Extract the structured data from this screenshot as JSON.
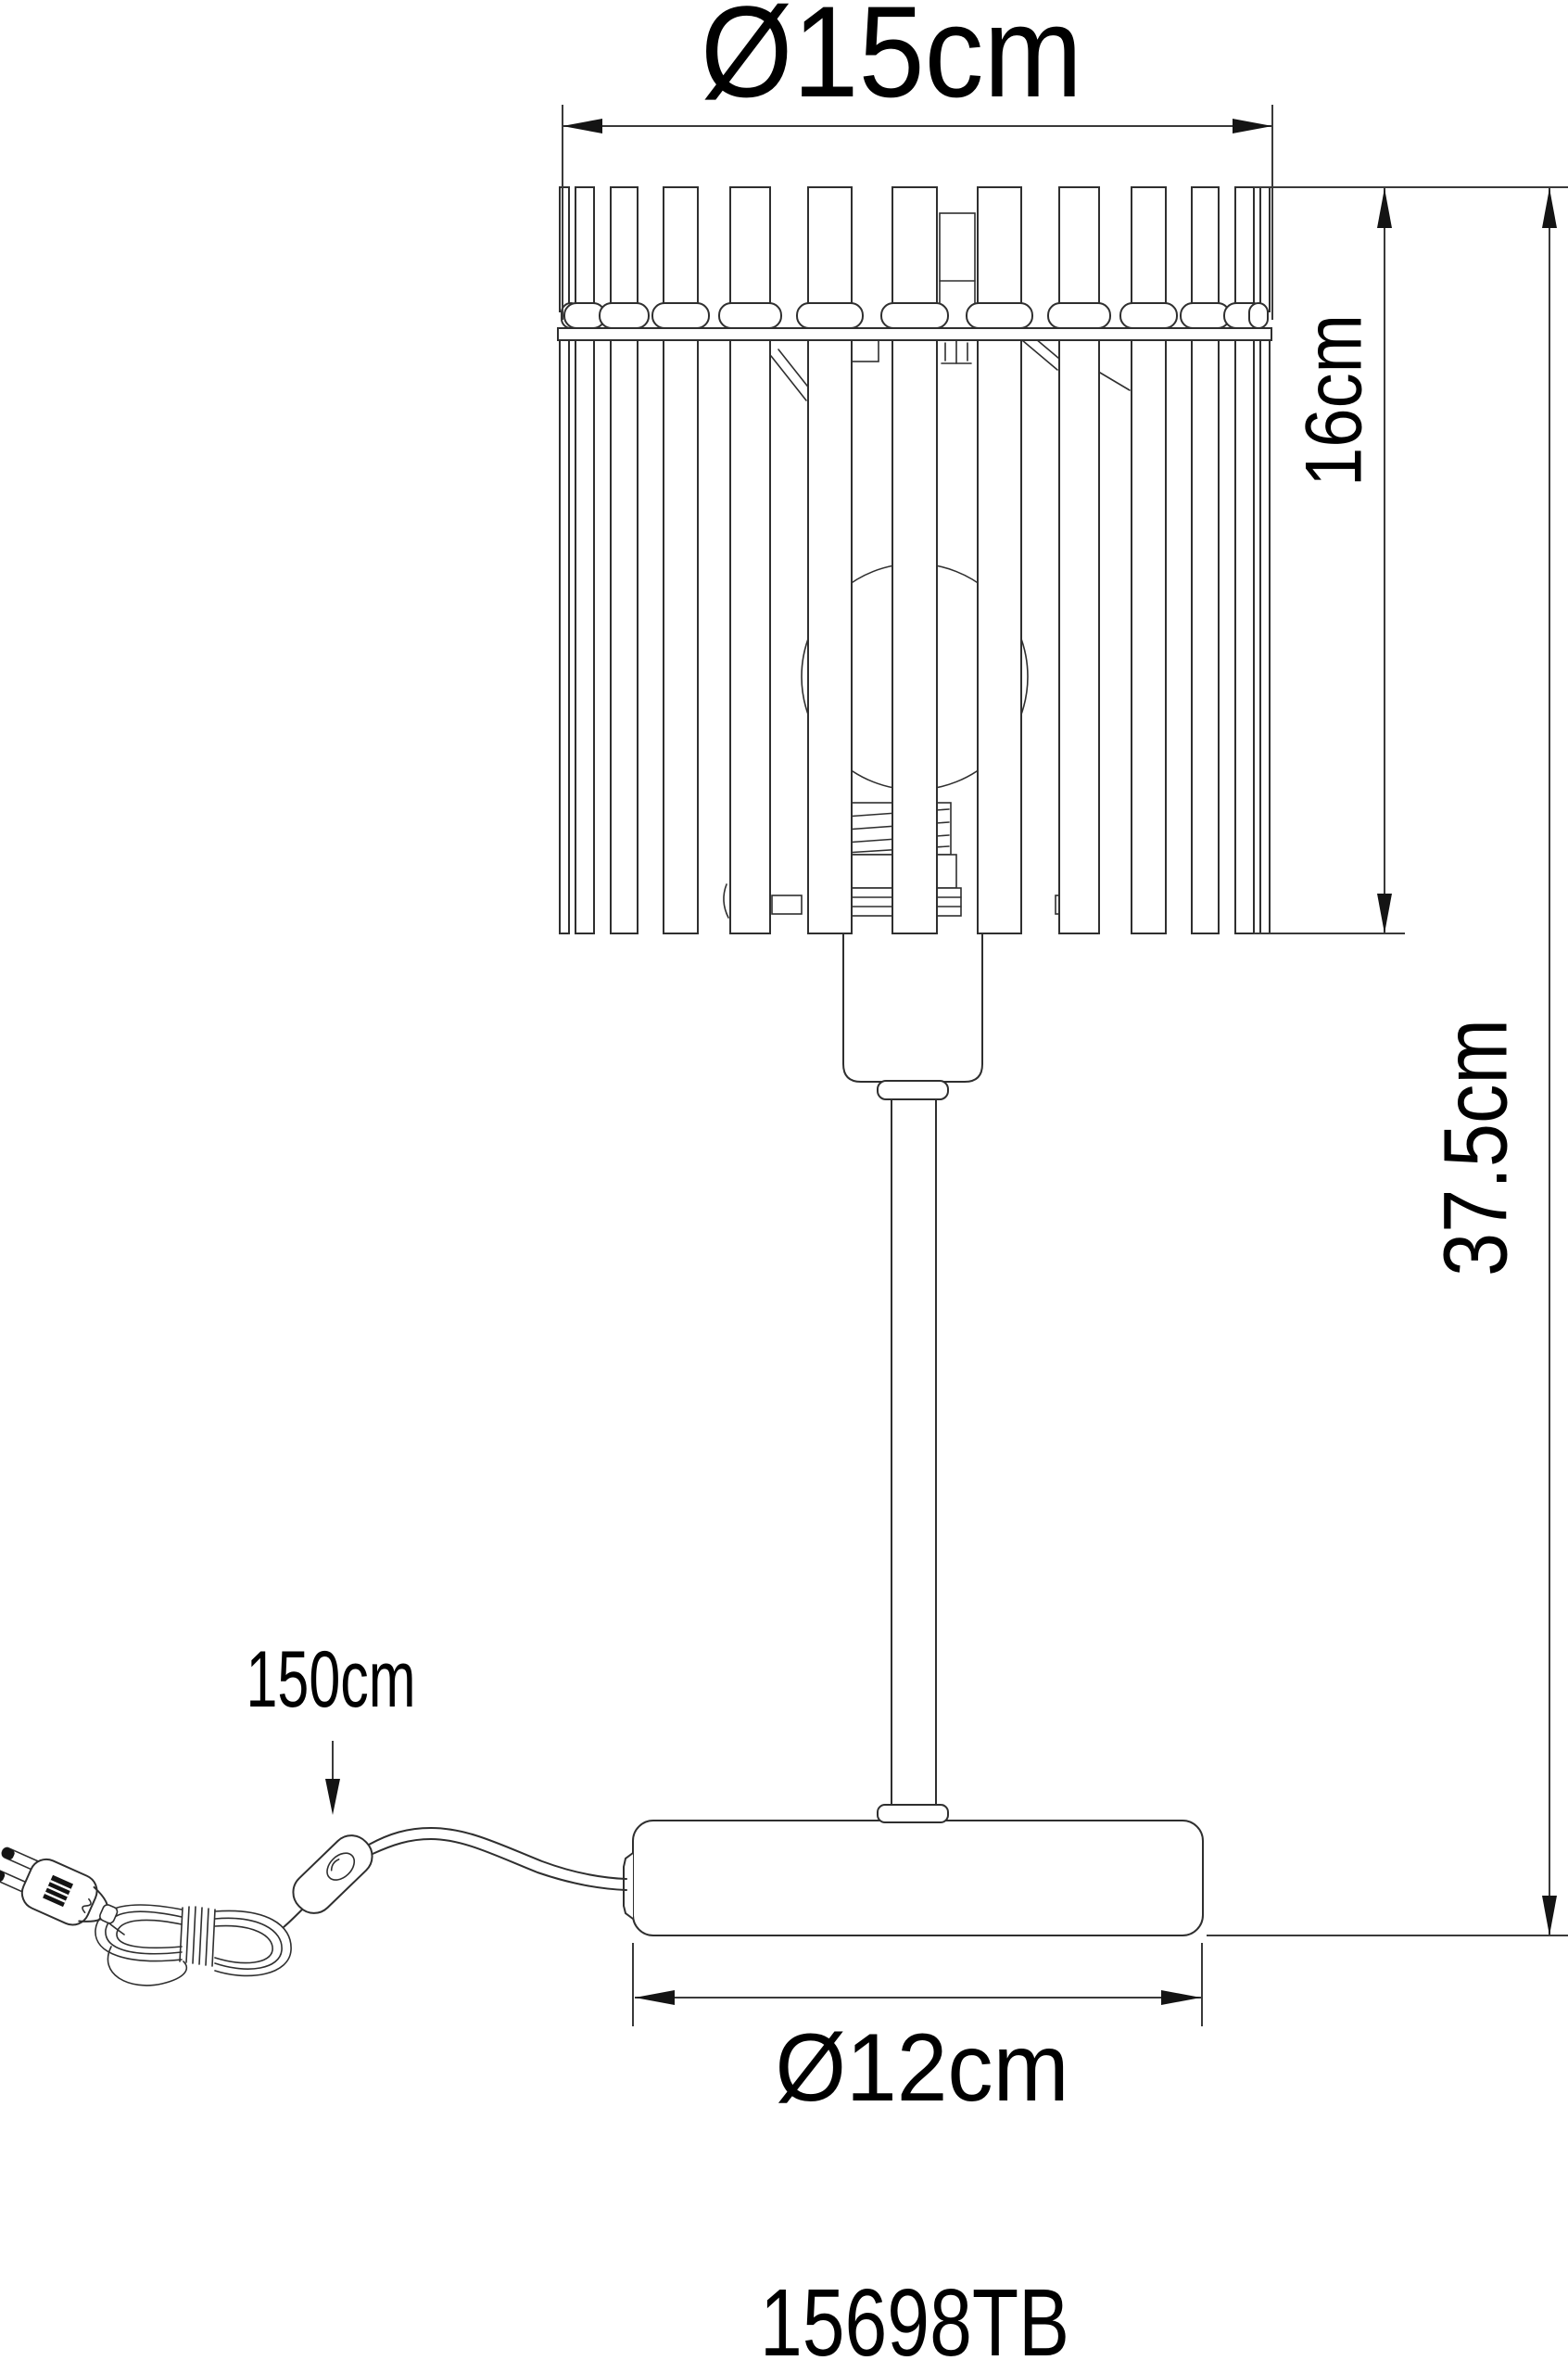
{
  "document": {
    "kind": "product dimension drawing",
    "background_color": "#ffffff",
    "line_color": "#2f2f2f",
    "text_color": "#000000"
  },
  "product": {
    "code": "15698TB"
  },
  "dimensions": {
    "shade_diameter": {
      "label": "Ø15cm",
      "value_cm": 15
    },
    "shade_height": {
      "label": "16cm",
      "value_cm": 16
    },
    "total_height": {
      "label": "37.5cm",
      "value_cm": 37.5
    },
    "cable_length": {
      "label": "150cm",
      "value_cm": 150
    },
    "base_diameter": {
      "label": "Ø12cm",
      "value_cm": 12
    }
  }
}
